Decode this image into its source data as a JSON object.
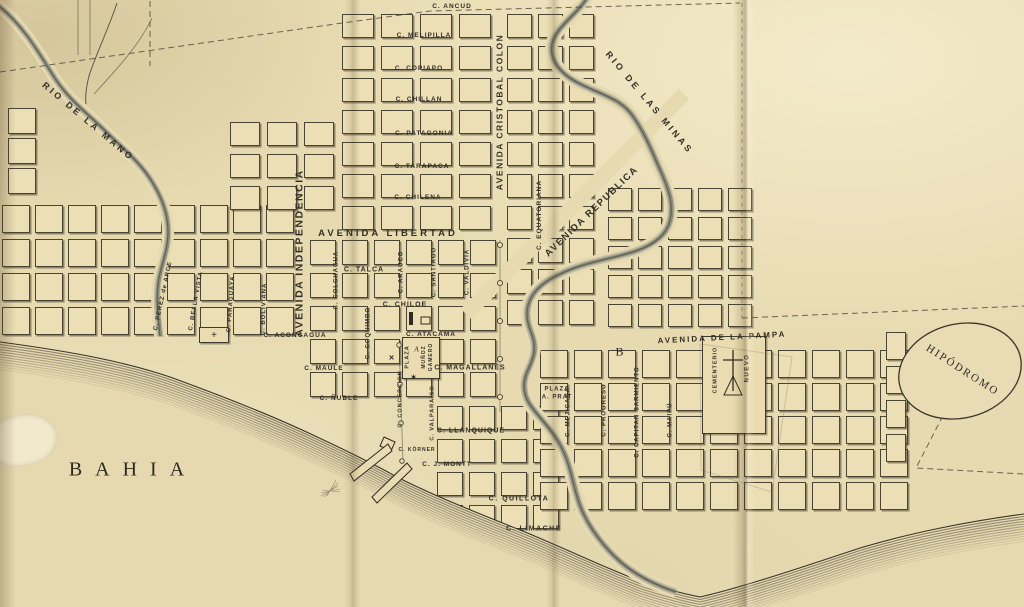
{
  "colors": {
    "paper": "#e7dab0",
    "block_fill": "#ecdfb5",
    "ink": "#332f27",
    "river": "#8e8e7c"
  },
  "labels": {
    "rio_de_la_mano": "RIO DE LA MANO",
    "rio_de_las_minas": "RIO DE LAS MINAS",
    "c_ancud": "C. ANCUD",
    "c_melipilla": "C. MELIPILLA",
    "c_copiapo": "C. COPIAPO",
    "c_chillan": "C. CHILLAN",
    "c_patagonia": "C. PATAGONIA",
    "c_tarapaca": "C. TARAPACA",
    "c_chilena": "C. CHILENA",
    "av_cristobal_colon": "AVENIDA CRISTOBAL COLON",
    "av_republica": "AVENIDA REPUBLICA",
    "av_libertad": "AVENIDA LIBERTAD",
    "av_independencia": "AVENIDA INDEPENDENCIA",
    "c_equatoriana": "C. EQUATORIANA",
    "c_perez_de_arce": "C. PEREZ de ARCE",
    "c_bella_vista": "C. BELLA VISTA",
    "c_paraguaya": "C. PARAGUAYA",
    "c_boliviana": "C. BOLIVIANA",
    "c_colchagua": "C. COLCHAGUA",
    "c_talca": "C. TALCA",
    "c_arauco": "C. ARAUCO",
    "c_santiago": "C. SANTIAGO",
    "c_valdivia": "C. VALDIVIA",
    "c_chiloe": "C. CHILOE",
    "c_coquimbo": "C. COQUIMBO",
    "c_aconcagua": "C. ACONCAGUA",
    "c_atacama": "C. ATACAMA",
    "c_maule": "C. MAULE",
    "plaza": "PLAZA",
    "plaza_a": "A",
    "munoz": "MUÑOZ",
    "gamero": "GAMERO",
    "c_magallanes": "C. MAGALLANES",
    "c_nuble": "C. ÑUBLE",
    "c_concepcion": "C. CONCEPCION",
    "c_valparaiso": "C. VALPARAISO",
    "c_llanquique": "C. LLANQUIQUE",
    "c_korner": "C. KÖRNER",
    "c_j_montt": "C. J. MONTT",
    "c_quillota": "C. QUILLOTA",
    "c_limache": "C. LIMACHE",
    "av_pampa": "AVENIDA DE LA PAMPA",
    "b_marker": "B",
    "plaza_a_prat": "PLAZA\nA. PRAT",
    "c_mejicana": "C. MEJICANA",
    "c_progreso": "C. PROGRESO",
    "c_capitan_sarmiento": "C. CAPITAN SARMIENTO",
    "c_maipu": "C. MAIPÚ",
    "cementerio": "CEMENTERIO",
    "nuevo": "NUEVO",
    "hipodromo": "HIPÓDROMO",
    "bahia": "BAHIA"
  },
  "markers": {
    "x_mark": "×",
    "plaza_star": "✶",
    "church_cross": "+"
  }
}
